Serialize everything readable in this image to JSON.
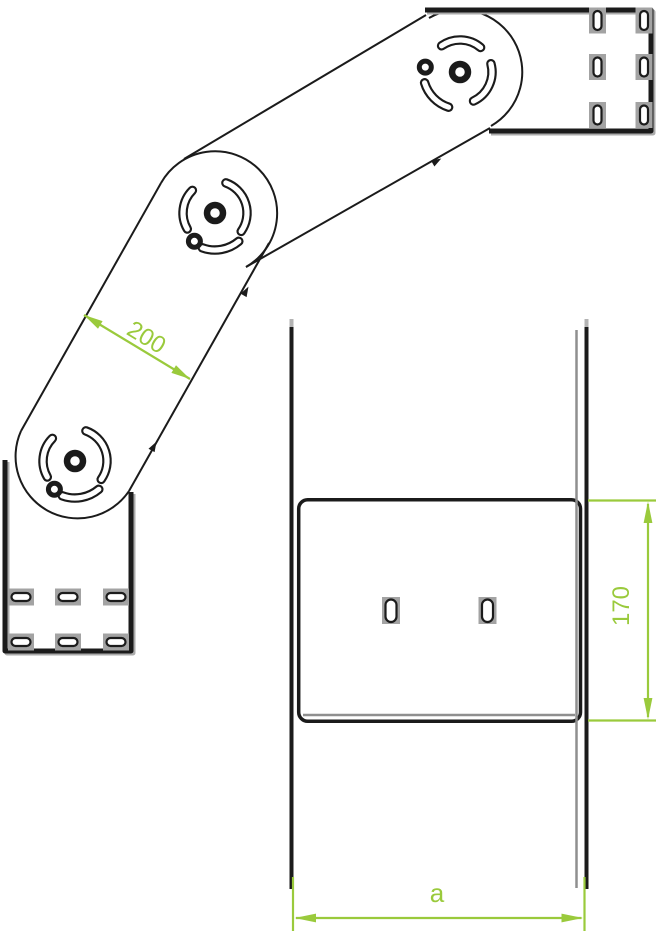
{
  "drawing_labels": {
    "arm_width": "200",
    "connector_height": "170",
    "tray_width": "a"
  },
  "colors": {
    "ink": "#1b1b1b",
    "dimension_green": "#9aca3c",
    "shadow_gray": "#ababab",
    "echo_gray": "#8f8f8f"
  }
}
